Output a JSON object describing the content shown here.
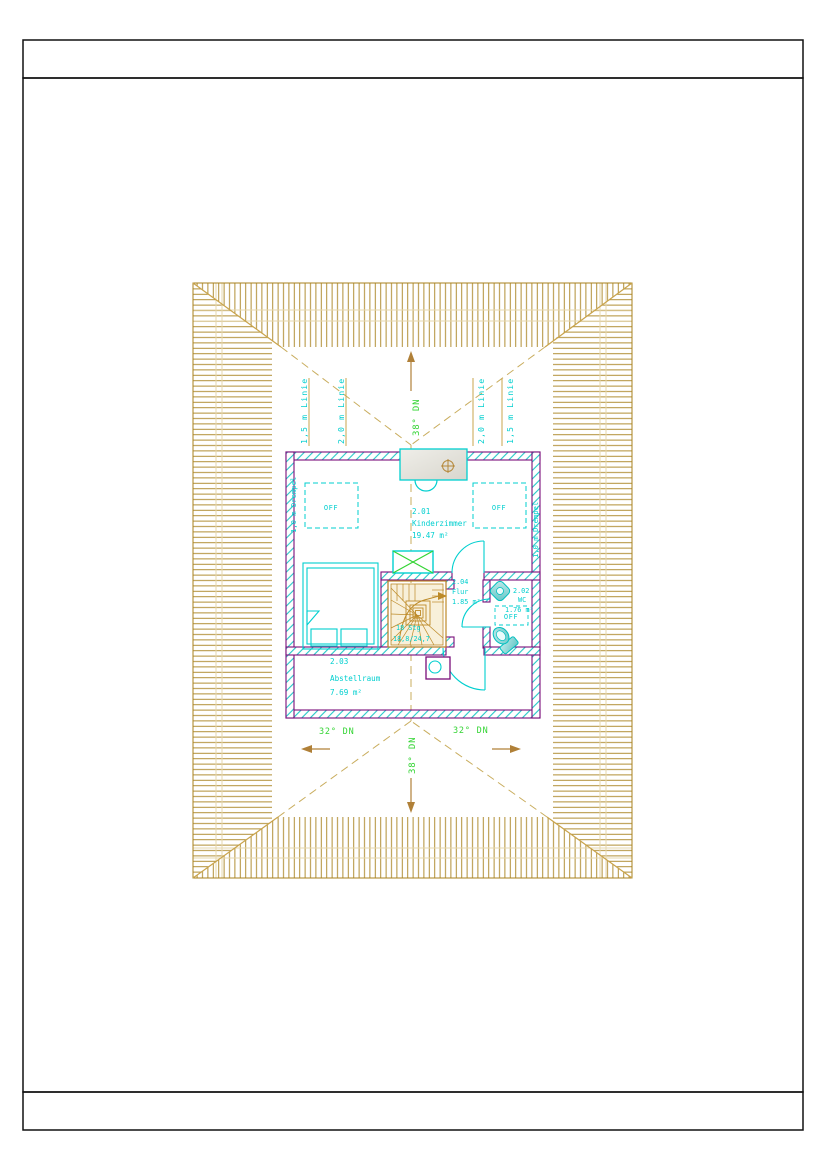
{
  "drawing": {
    "kind": "attic floor plan with roof outline",
    "roof": {
      "pitch_top": "38° DN",
      "pitch_bottom": "38° DN",
      "pitch_left": "32° DN",
      "pitch_right": "32° DN",
      "height_lines": {
        "left_outer": "1,5 m Linie",
        "left_inner": "2,0 m Linie",
        "right_inner": "2,0 m Linie",
        "right_outer": "1,5 m Linie"
      }
    },
    "plan": {
      "rooms": [
        {
          "number": "2.01",
          "name": "Kinderzimmer",
          "area": "19.47 m²"
        },
        {
          "number": "2.02",
          "name": "WC",
          "area": "1.76 m²"
        },
        {
          "number": "2.03",
          "name": "Abstellraum",
          "area": "7.69 m²"
        },
        {
          "number": "2.04",
          "name": "Flur",
          "area": "1.85 m²"
        }
      ],
      "skylight_label": "OFF",
      "knee_wall_label_left": "1,0 m Drempel",
      "knee_wall_label_right": "1,0 m Drempel",
      "stair": {
        "risers": "18 Stg",
        "rise_run": "18,8/24,7"
      }
    },
    "colors": {
      "wall_purple": "#7a0d7a",
      "fixture_cyan": "#00cfcf",
      "roof_hatch_gold": "#a8821e",
      "hip_line_tan": "#c9ad5e",
      "annotation_green": "#33d433",
      "stair_orange": "#bd8a28"
    }
  }
}
